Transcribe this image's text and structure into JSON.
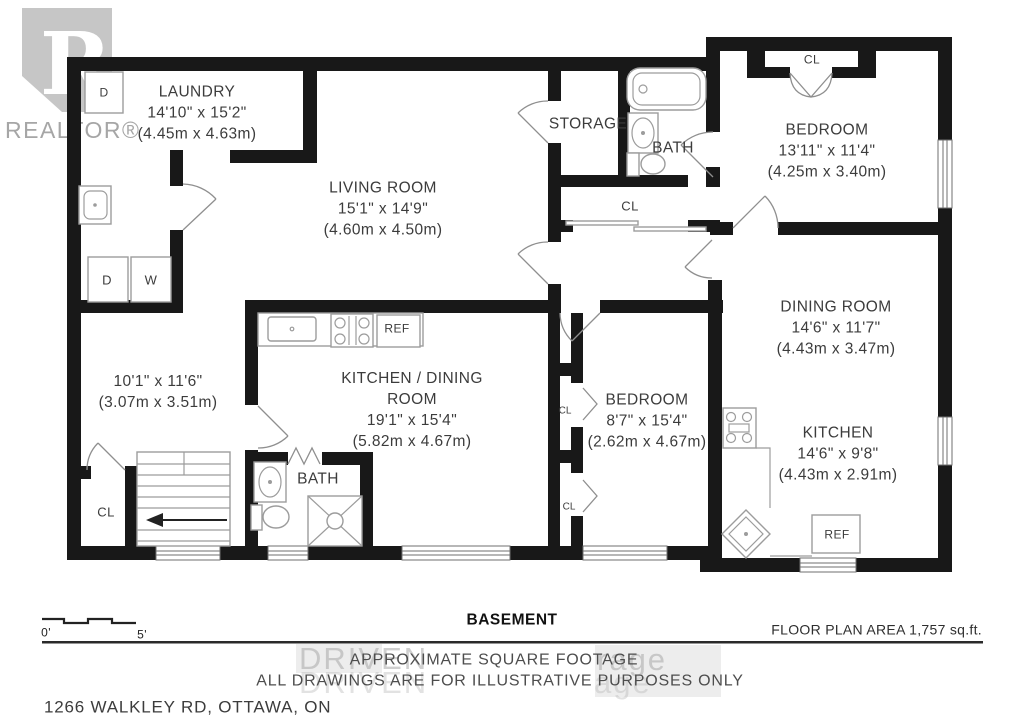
{
  "branding": {
    "logo_letter": "R",
    "logo_text": "REALTOR®",
    "watermark_top_left": "DRIVEN",
    "watermark_top_right": "rage",
    "watermark_bottom_left": "DRIVEN",
    "watermark_bottom_right": "age"
  },
  "rooms": {
    "laundry": {
      "name": "LAUNDRY",
      "dims_ft": "14'10\" x 15'2\"",
      "dims_m": "(4.45m x 4.63m)"
    },
    "living_room": {
      "name": "LIVING ROOM",
      "dims_ft": "15'1\" x 14'9\"",
      "dims_m": "(4.60m x 4.50m)"
    },
    "storage": {
      "name": "STORAGE"
    },
    "bath_upper": {
      "name": "BATH"
    },
    "bedroom_ne": {
      "name": "BEDROOM",
      "dims_ft": "13'11\" x 11'4\"",
      "dims_m": "(4.25m x 3.40m)"
    },
    "dining_room": {
      "name": "DINING ROOM",
      "dims_ft": "14'6\" x 11'7\"",
      "dims_m": "(4.43m x 3.47m)"
    },
    "room_sw": {
      "dims_ft": "10'1\" x 11'6\"",
      "dims_m": "(3.07m x 3.51m)"
    },
    "kitchen_dining": {
      "name_line1": "KITCHEN / DINING",
      "name_line2": "ROOM",
      "dims_ft": "19'1\" x 15'4\"",
      "dims_m": "(5.82m x 4.67m)"
    },
    "bedroom_s": {
      "name": "BEDROOM",
      "dims_ft": "8'7\" x 15'4\"",
      "dims_m": "(2.62m x 4.67m)"
    },
    "kitchen_e": {
      "name": "KITCHEN",
      "dims_ft": "14'6\" x 9'8\"",
      "dims_m": "(4.43m x 2.91m)"
    },
    "bath_lower": {
      "name": "BATH"
    }
  },
  "fixtures": {
    "closet": "CL",
    "dryer": "D",
    "washer": "W",
    "fridge": "REF"
  },
  "footer": {
    "plan_name": "BASEMENT",
    "area": "FLOOR PLAN AREA 1,757 sq.ft.",
    "disclaimer_line1": "APPROXIMATE SQUARE FOOTAGE",
    "disclaimer_line2": "ALL DRAWINGS ARE FOR ILLUSTRATIVE PURPOSES ONLY",
    "address": "1266 WALKLEY RD, OTTAWA, ON",
    "scale_start": "0'",
    "scale_end": "5'"
  },
  "colors": {
    "wall": "#181818",
    "label_text": "#3c3c3c",
    "fixture_line": "#9c9c9c",
    "watermark_gray": "#bdbdbd"
  }
}
